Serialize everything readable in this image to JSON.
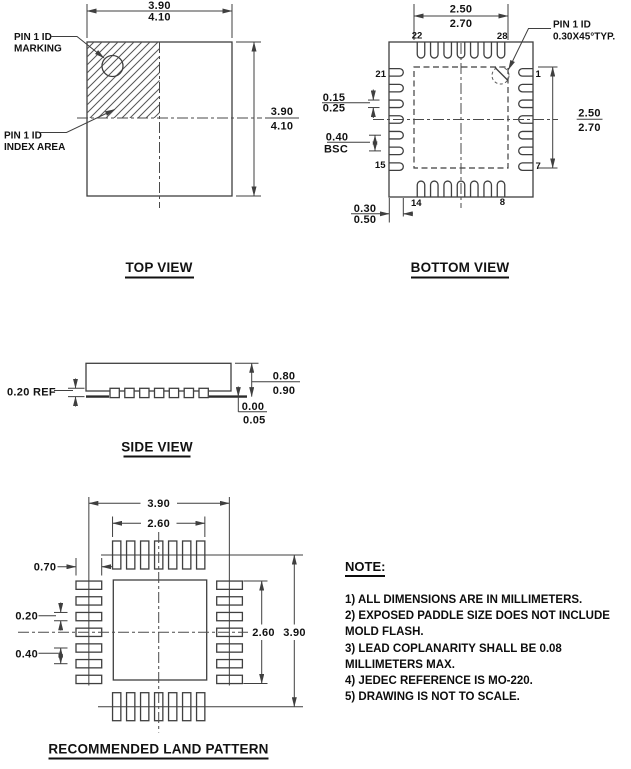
{
  "views": {
    "top": {
      "title": "TOP VIEW",
      "dim_width": {
        "min": "3.90",
        "max": "4.10"
      },
      "dim_height": {
        "min": "3.90",
        "max": "4.10"
      },
      "marking_label": {
        "l1": "PIN 1 ID",
        "l2": "MARKING"
      },
      "index_label": {
        "l1": "PIN 1 ID",
        "l2": "INDEX AREA"
      }
    },
    "bottom": {
      "title": "BOTTOM VIEW",
      "pad_width": {
        "min": "2.50",
        "max": "2.70"
      },
      "pad_height": {
        "min": "2.50",
        "max": "2.70"
      },
      "lead_width": {
        "min": "0.15",
        "max": "0.25"
      },
      "lead_pitch": {
        "value": "0.40",
        "qualifier": "BSC"
      },
      "lead_length": {
        "min": "0.30",
        "max": "0.50"
      },
      "pin1_label": {
        "l1": "PIN 1 ID",
        "l2": "0.30X45°TYP."
      },
      "pin_numbers": {
        "top_left": "22",
        "top_right": "28",
        "left_top": "21",
        "left_bottom": "15",
        "right_top": "1",
        "right_bottom": "7",
        "bottom_left": "14",
        "bottom_right": "8"
      }
    },
    "side": {
      "title": "SIDE VIEW",
      "lead_thickness": "0.20 REF",
      "height": {
        "min": "0.80",
        "max": "0.90"
      },
      "standoff": {
        "min": "0.00",
        "max": "0.05"
      }
    },
    "land": {
      "title": "RECOMMENDED LAND PATTERN",
      "overall_width": "3.90",
      "pad_row_span": "2.60",
      "pad_length": "0.70",
      "pad_width": "0.20",
      "pad_pitch": "0.40",
      "pad_col_span": "2.60",
      "overall_height": "3.90"
    }
  },
  "note": {
    "heading": "NOTE:",
    "lines": [
      "1) ALL DIMENSIONS ARE IN MILLIMETERS.",
      "2) EXPOSED PADDLE SIZE DOES NOT INCLUDE",
      "MOLD FLASH.",
      "3) LEAD COPLANARITY SHALL BE 0.08",
      "MILLIMETERS MAX.",
      "4) JEDEC REFERENCE IS MO-220.",
      "5) DRAWING IS NOT TO SCALE."
    ]
  }
}
